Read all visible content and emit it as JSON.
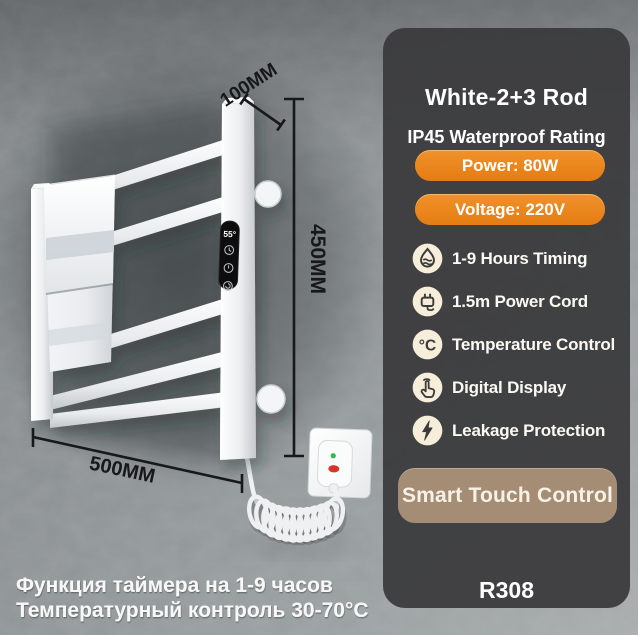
{
  "scene": {
    "dimensions": {
      "top_depth": "100MM",
      "side_height": "450MM",
      "bottom_width": "500MM"
    },
    "display": {
      "value": "55°",
      "buttons": [
        "clock-icon",
        "power-icon",
        "timer-icon"
      ]
    },
    "captions": [
      "Функция таймера на 1-9 часов",
      "Температурный контроль 30-70°C"
    ]
  },
  "panel": {
    "title": "White-2+3 Rod",
    "subtitle": "IP45 Waterproof Rating",
    "spec_buttons": [
      {
        "label": "Power: 80W"
      },
      {
        "label": "Voltage: 220V"
      }
    ],
    "features": [
      {
        "icon": "drop-waves-icon",
        "label": "1-9 Hours Timing"
      },
      {
        "icon": "power-plug-icon",
        "label": "1.5m Power Cord"
      },
      {
        "icon": "celsius-icon",
        "label": "Temperature Control"
      },
      {
        "icon": "touch-hand-icon",
        "label": "Digital Display"
      },
      {
        "icon": "lightning-icon",
        "label": "Leakage Protection"
      }
    ],
    "cta_label": "Smart Touch Control",
    "model": "R308",
    "colors": {
      "accent_orange": "#ea851d",
      "panel_bg": "#3a3a3d",
      "cta_bg": "#a48c75",
      "icon_circle": "#f6eeda",
      "annotation": "#17181a"
    }
  }
}
